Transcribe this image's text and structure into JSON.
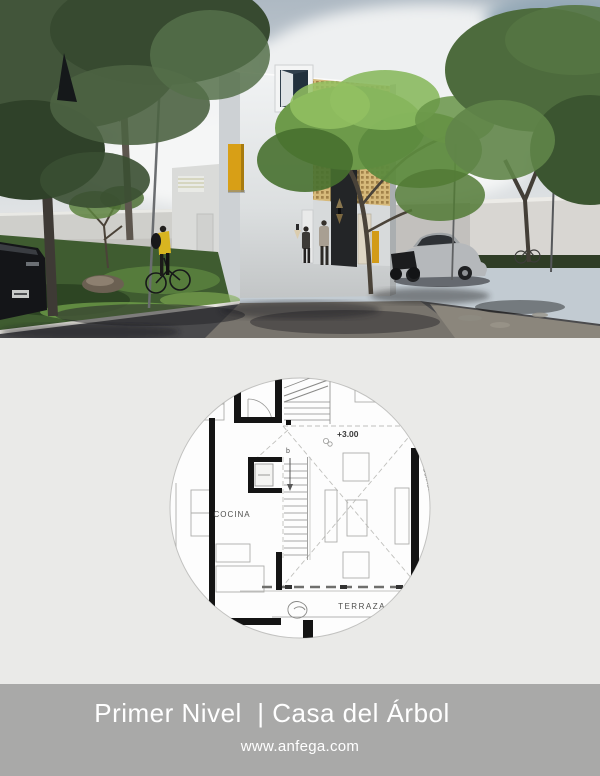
{
  "footer": {
    "title": "Primer Nivel  | Casa del Árbol",
    "website": "www.anfega.com"
  },
  "floor_plan": {
    "level_label": "+3.00",
    "stair_label": "b",
    "kitchen_label": "COCINA",
    "terrace_label": "TERRAZA",
    "boundary_label": "Colinda"
  },
  "colors": {
    "accent_yellow": "#d29b18",
    "lattice_tan": "#d9bd80",
    "footer_gray": "#a9a9a8",
    "plan_background": "#eaeae8",
    "plan_circle": "#fdfdfd",
    "wall_black": "#141414",
    "foliage_green": "#6d9a4a"
  }
}
